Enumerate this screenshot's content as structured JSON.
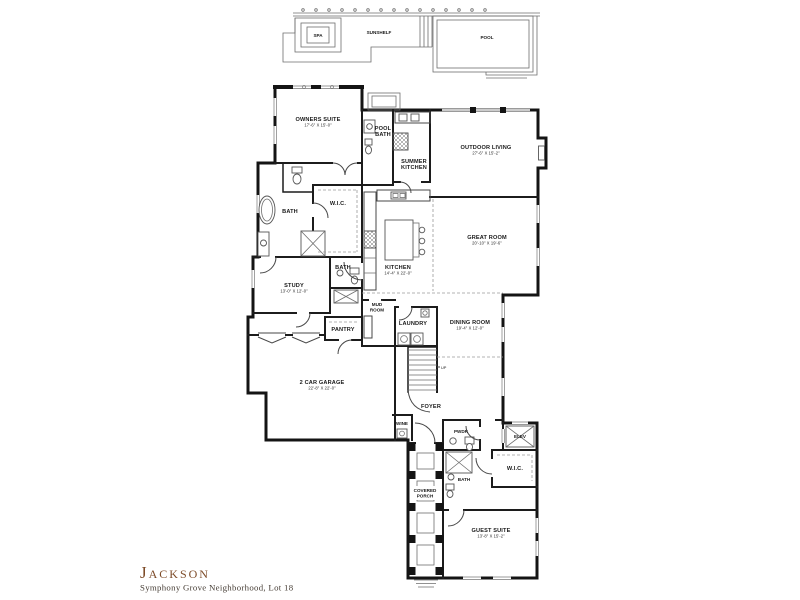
{
  "canvas": {
    "background": "#ffffff",
    "wall_color": "#141414",
    "thin_line_color": "#6e6e6e",
    "accent_color": "#7d4b28"
  },
  "pool_area": {
    "spa": "SPA",
    "sunshelf": "SUNSHELF",
    "pool": "POOL"
  },
  "rooms": {
    "owners_suite": {
      "name": "OWNERS SUITE",
      "dims": "17'-6\" X 15'-0\""
    },
    "pool_bath": {
      "l1": "POOL",
      "l2": "BATH"
    },
    "summer_kitchen": {
      "l1": "SUMMER",
      "l2": "KITCHEN"
    },
    "outdoor_living": {
      "name": "OUTDOOR LIVING",
      "dims": "27'-6\" X 15'-2\""
    },
    "great_room": {
      "name": "GREAT ROOM",
      "dims": "20'-10\" X 19'-6\""
    },
    "kitchen": {
      "name": "KITCHEN",
      "dims": "14'-4\" X 22'-0\""
    },
    "owners_bath": {
      "name": "BATH"
    },
    "owners_wic": {
      "name": "W.I.C."
    },
    "study": {
      "name": "STUDY",
      "dims": "13'-0\" X 12'-0\""
    },
    "hall_bath": {
      "name": "BATH"
    },
    "pantry": {
      "name": "PANTRY"
    },
    "mud_room": {
      "l1": "MUD",
      "l2": "ROOM"
    },
    "laundry": {
      "name": "LAUNDRY"
    },
    "dining_room": {
      "name": "DINING ROOM",
      "dims": "19'-4\" X 12'-0\""
    },
    "garage": {
      "name": "2 CAR GARAGE",
      "dims": "22'-8\" X 22'-0\""
    },
    "foyer": {
      "name": "FOYER"
    },
    "wine": {
      "name": "WINE"
    },
    "stairs": {
      "label": "UP"
    },
    "powder": {
      "name": "PWDR"
    },
    "elevator": {
      "name": "ELEV"
    },
    "guest_wic": {
      "name": "W.I.C."
    },
    "guest_bath": {
      "name": "BATH"
    },
    "covered_porch": {
      "l1": "COVERED",
      "l2": "PORCH"
    },
    "guest_suite": {
      "name": "GUEST SUITE",
      "dims": "13'-8\" X 15'-2\""
    }
  },
  "title_block": {
    "plan_name": "Jackson",
    "subtitle": "Symphony Grove Neighborhood, Lot 18"
  }
}
